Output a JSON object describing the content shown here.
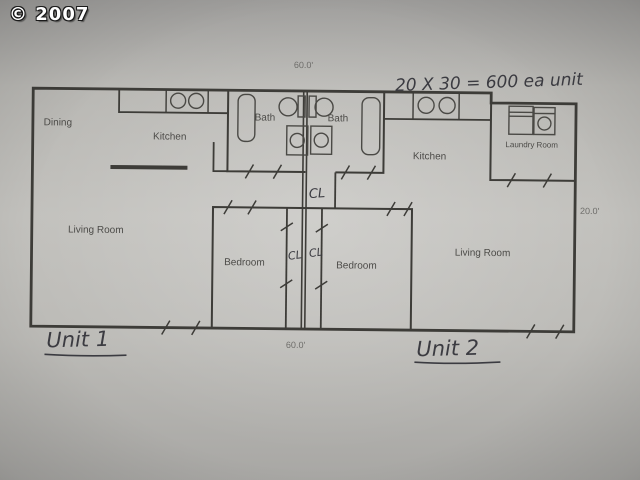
{
  "photo": {
    "copyright": "© 2007"
  },
  "plan": {
    "rooms": {
      "dining": "Dining",
      "kitchen_unit1": "Kitchen",
      "bath_unit1": "Bath",
      "bath_unit2": "Bath",
      "kitchen_unit2": "Kitchen",
      "laundry_room": "Laundry Room",
      "living_room_unit1": "Living Room",
      "living_room_unit2": "Living Room",
      "bedroom_unit1": "Bedroom",
      "bedroom_unit2": "Bedroom",
      "closet_hall": "CL",
      "closet_bedroom_unit1": "CL",
      "closet_bedroom_unit2": "CL"
    },
    "dimensions": {
      "width_top": "60.0'",
      "width_bottom": "60.0'",
      "depth_right": "20.0'"
    },
    "handwritten": {
      "area_note": "20 X 30 = 600 ea unit",
      "unit1_label": "Unit 1",
      "unit2_label": "Unit 2"
    }
  },
  "colors": {
    "paper": "#c2c1bd",
    "ink": "#3d3c38",
    "pencil": "#3b3b41",
    "watermark_text": "#ffffff"
  }
}
